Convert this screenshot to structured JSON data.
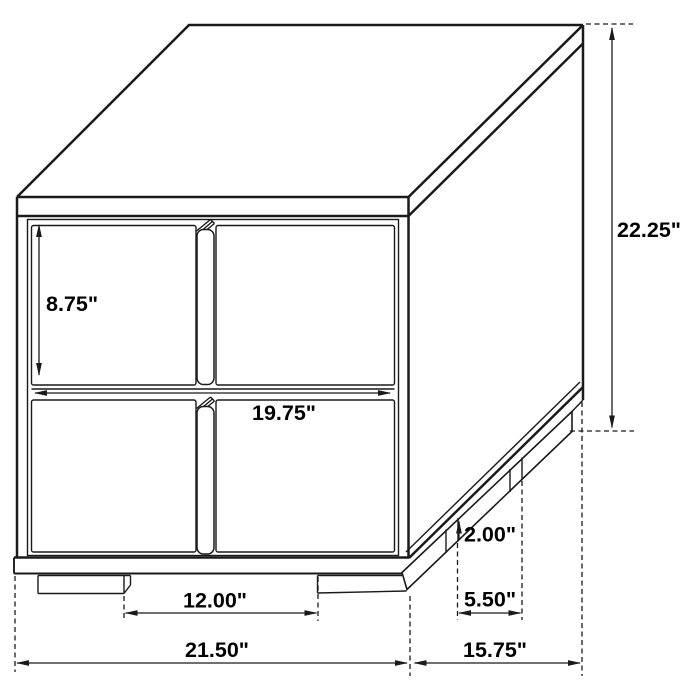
{
  "figure": {
    "kind": "furniture dimension diagram",
    "subject": "two-drawer nightstand line drawing"
  },
  "dimensions": {
    "overall_height": "22.25\"",
    "drawer_front_height": "8.75\"",
    "drawer_width": "19.75\"",
    "leg_height": "2.00\"",
    "side_leg_spacing": "5.50\"",
    "front_leg_spacing": "12.00\"",
    "overall_width": "21.50\"",
    "overall_depth": "15.75\""
  },
  "colors": {
    "line": "#1a1a1a",
    "background": "#ffffff",
    "text": "#000000"
  }
}
